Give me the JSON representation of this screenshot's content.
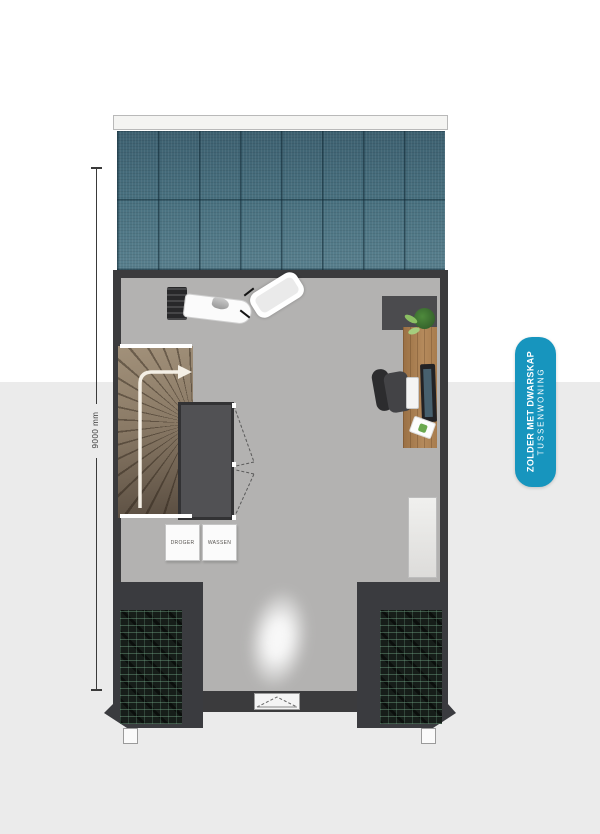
{
  "dimension": {
    "label": "9000 mm"
  },
  "badge": {
    "title": "ZOLDER MET DWARSKAP",
    "subtitle": "TUSSENWONING"
  },
  "laundry": {
    "dryer_label": "DROGER",
    "washer_label": "WASSEN"
  },
  "colors": {
    "accent": "#1795be",
    "wall": "#3b3b3d",
    "floor": "#b3b2b1",
    "solar_panel": "#48707f",
    "stairs_wood": "#8a7a66",
    "desk_wood": "#b58a5c",
    "roof_hatch": "#161d19",
    "background_band": "#ebebeb"
  }
}
